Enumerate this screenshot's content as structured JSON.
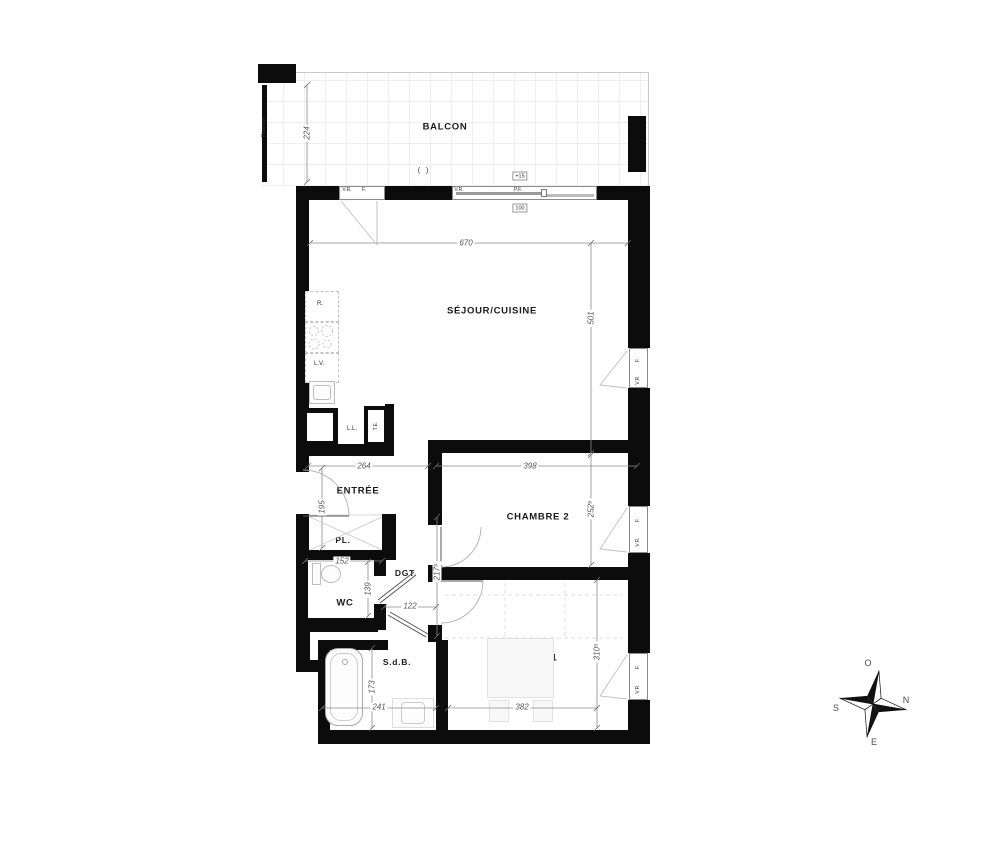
{
  "plan": {
    "rooms": {
      "balcon": "BALCON",
      "sejour": "SÉJOUR/CUISINE",
      "entree": "ENTRÉE",
      "placard": "PL.",
      "wc": "WC",
      "degagement": "DGT.",
      "sdb": "S.d.B.",
      "chambre1": "CHAMBRE 1",
      "chambre2": "CHAMBRE 2"
    },
    "dims": {
      "balcon_depth": "224",
      "sejour_width": "670",
      "sejour_height": "501",
      "entree_width": "264",
      "entree_height": "195",
      "chambre2_width": "398",
      "chambre2_height": "252⁵",
      "placard_width": "152",
      "wc_height": "139",
      "degagement_width": "122",
      "degagement_height": "217⁵",
      "sdb_width": "241",
      "sdb_height": "173",
      "chambre1_width": "382",
      "chambre1_height": "310⁵"
    },
    "openings": {
      "vr": "V.R.",
      "f": "F.",
      "pf": "P.F.",
      "door_symbol": "( )",
      "sill_height": "+15",
      "pf_width": "100"
    },
    "fixtures": {
      "fridge": "R.",
      "dishwasher": "L.V.",
      "washer": "L.L.",
      "elec_panel": "T.E."
    },
    "annotations": {
      "pare_vue": "Pare-vue"
    },
    "compass": {
      "north": "N",
      "south": "S",
      "east": "E",
      "west": "O"
    },
    "colors": {
      "wall": "#0c0c0c",
      "dim_line": "#8a8a8a",
      "fixture_line": "#c4c4c4"
    }
  }
}
